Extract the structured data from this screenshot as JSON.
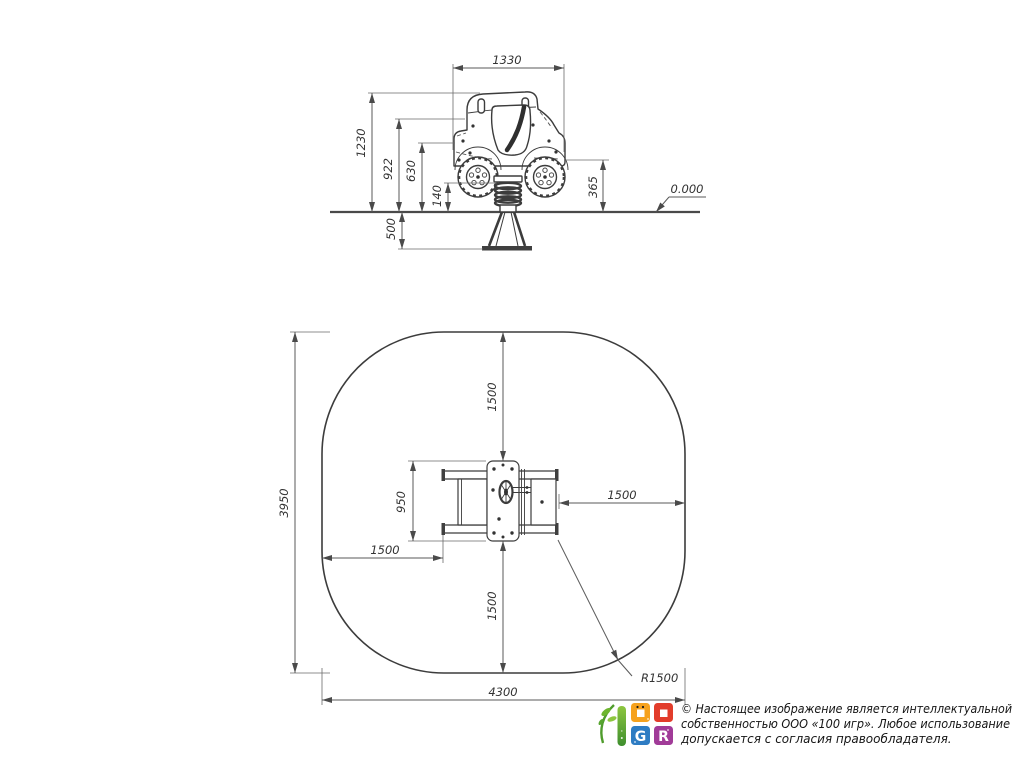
{
  "page": {
    "background": "#ffffff"
  },
  "side_view": {
    "dim_width": "1330",
    "dim_height_total": "1230",
    "dim_height_hood": "922",
    "dim_height_body": "630",
    "dim_height_spring": "140",
    "dim_height_step": "365",
    "dim_foundation_depth": "500",
    "ground_level": "0.000"
  },
  "plan_view": {
    "dim_zone_depth": "3950",
    "dim_zone_width": "4300",
    "dim_clearance_top": "1500",
    "dim_clearance_bottom": "1500",
    "dim_clearance_left": "1500",
    "dim_clearance_right": "1500",
    "dim_equipment_width": "950",
    "dim_corner_radius": "R1500"
  },
  "footer": {
    "copyright_line1": "© Настоящее изображение является интеллектуальной",
    "copyright_line2": "собственностью ООО «100 игр».  Любое использование",
    "copyright_line3": "допускается с согласия правообладателя.",
    "logo_letter_g": "G",
    "logo_letter_r": "R"
  },
  "colors": {
    "line": "#3c3c3c",
    "dim_line": "#5a5a5a",
    "text": "#333333",
    "logo_green": "#6ab32f",
    "logo_orange": "#f6a21e",
    "logo_red": "#e23c2b",
    "logo_blue": "#2e7cc3",
    "logo_purple": "#a13b98"
  }
}
